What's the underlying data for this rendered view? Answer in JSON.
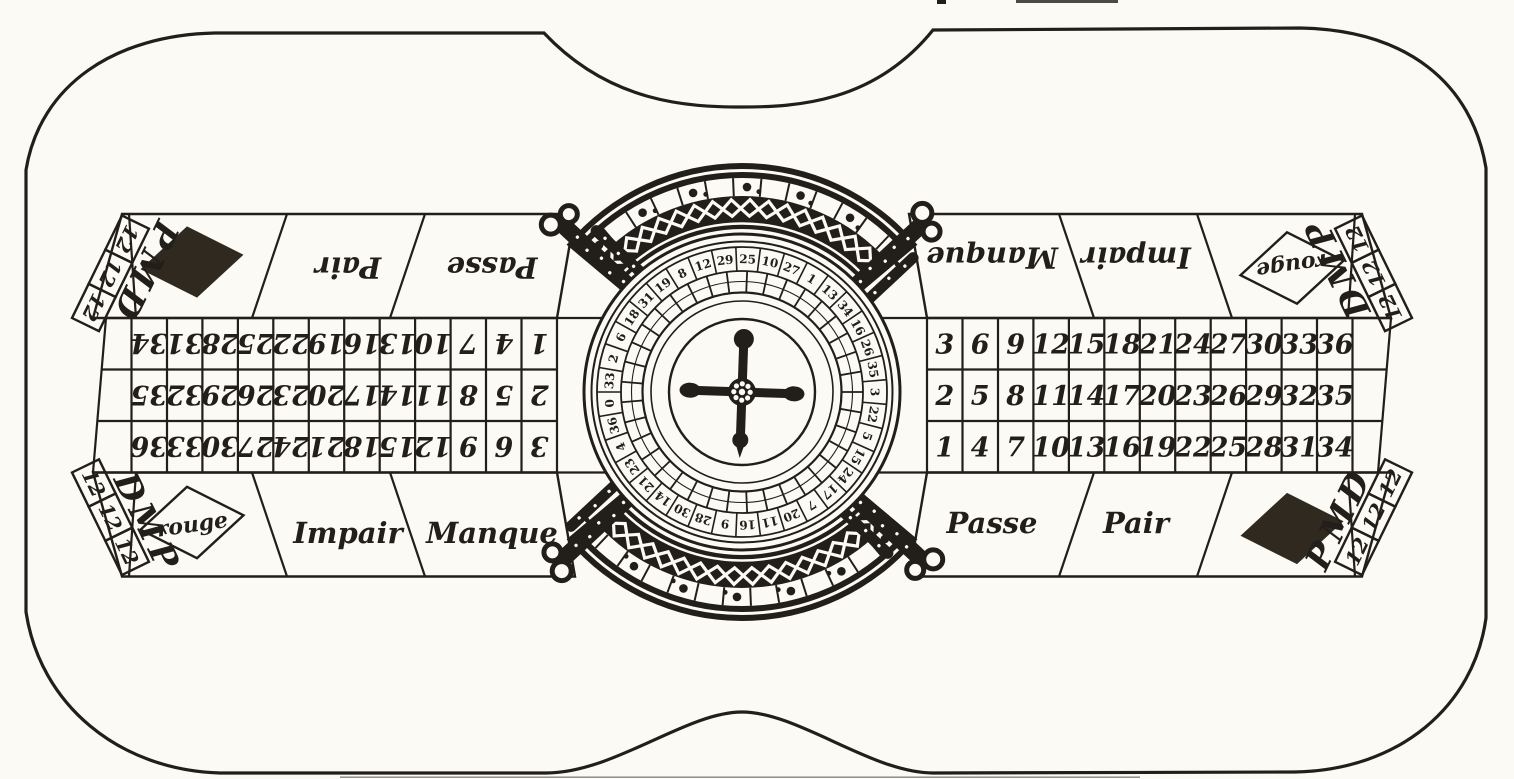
{
  "colors": {
    "paper": "#fbfaf5",
    "ink": "#221e19",
    "diamond_fill": "#30291f"
  },
  "halves": {
    "left": {
      "grid_rows_printed": [
        [
          "34",
          "31",
          "28",
          "25",
          "22",
          "19",
          "16",
          "13",
          "10",
          "7",
          "4",
          "1"
        ],
        [
          "35",
          "32",
          "29",
          "26",
          "23",
          "20",
          "17",
          "14",
          "11",
          "8",
          "5",
          "2"
        ],
        [
          "36",
          "33",
          "30",
          "27",
          "24",
          "21",
          "18",
          "15",
          "12",
          "9",
          "6",
          "3"
        ]
      ],
      "top_labels": [
        "Pair",
        "Passe"
      ],
      "bottom_labels": [
        "rouge",
        "Impair",
        "Manque"
      ]
    },
    "right": {
      "grid_rows_printed": [
        [
          "3",
          "6",
          "9",
          "12",
          "15",
          "18",
          "21",
          "24",
          "27",
          "30",
          "33",
          "36"
        ],
        [
          "2",
          "5",
          "8",
          "11",
          "14",
          "17",
          "20",
          "23",
          "26",
          "29",
          "32",
          "35"
        ],
        [
          "1",
          "4",
          "7",
          "10",
          "13",
          "16",
          "19",
          "22",
          "25",
          "28",
          "31",
          "34"
        ]
      ],
      "top_labels": [
        "Manque",
        "Impair",
        "rouge"
      ],
      "bottom_labels": [
        "Passe",
        "Pair"
      ]
    }
  },
  "dozens": {
    "value": "12",
    "letters": [
      "P",
      "M",
      "D"
    ]
  },
  "wheel": {
    "numbers": [
      "33",
      "2",
      "6",
      "18",
      "31",
      "19",
      "8",
      "12",
      "29",
      "25",
      "10",
      "27",
      "1",
      "13",
      "34",
      "16",
      "26",
      "35",
      "3",
      "22",
      "5",
      "15",
      "24",
      "17",
      "7",
      "20",
      "11",
      "16",
      "9",
      "28",
      "30",
      "14",
      "21",
      "23",
      "4",
      "36",
      "0"
    ]
  }
}
